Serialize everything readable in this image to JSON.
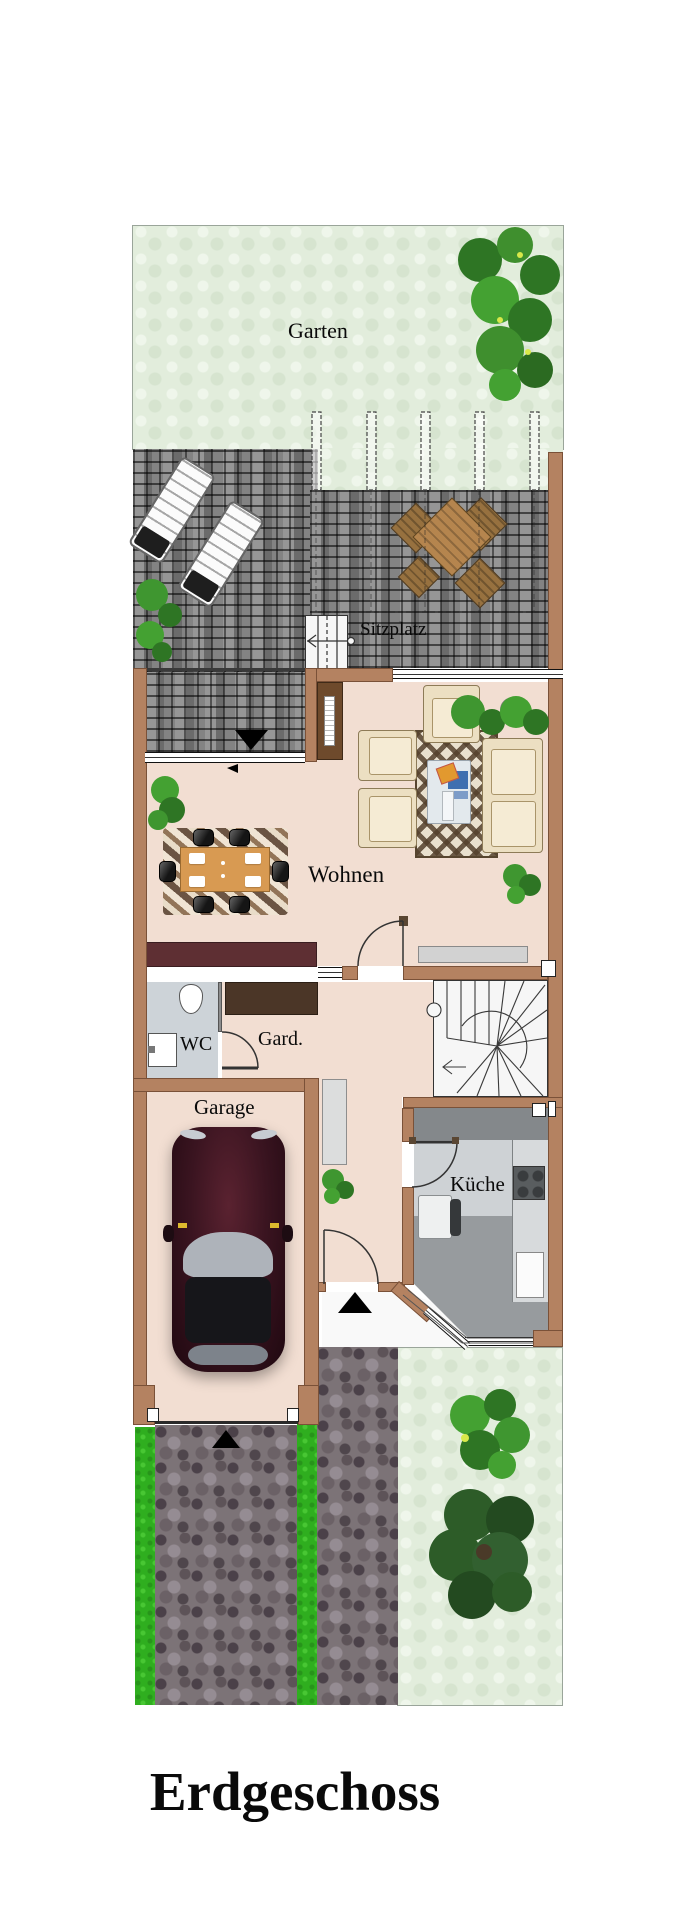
{
  "title": "Erdgeschoss",
  "floor_plan": {
    "rooms": [
      {
        "id": "garden",
        "label": "Garten"
      },
      {
        "id": "terrace",
        "label": "Sitzplatz"
      },
      {
        "id": "living",
        "label": "Wohnen"
      },
      {
        "id": "wc",
        "label": "WC"
      },
      {
        "id": "wardrobe",
        "label": "Gard."
      },
      {
        "id": "garage",
        "label": "Garage"
      },
      {
        "id": "kitchen",
        "label": "Küche"
      }
    ]
  },
  "palette": {
    "wall": "#b48261",
    "interior_floor": "#f2ded2",
    "garden_green": "#e2eddc",
    "terrace_stone": "#5a5a5a",
    "pavement": "#7c7377",
    "grass": "#2fae1f",
    "kitchen_floor": "#979b9e",
    "wc_floor": "#cdd3d8",
    "sideboard_red": "#5e2f33",
    "wardrobe_brown": "#4b3627",
    "car_body": "#3a1420",
    "label_text": "#0a0a0a"
  }
}
